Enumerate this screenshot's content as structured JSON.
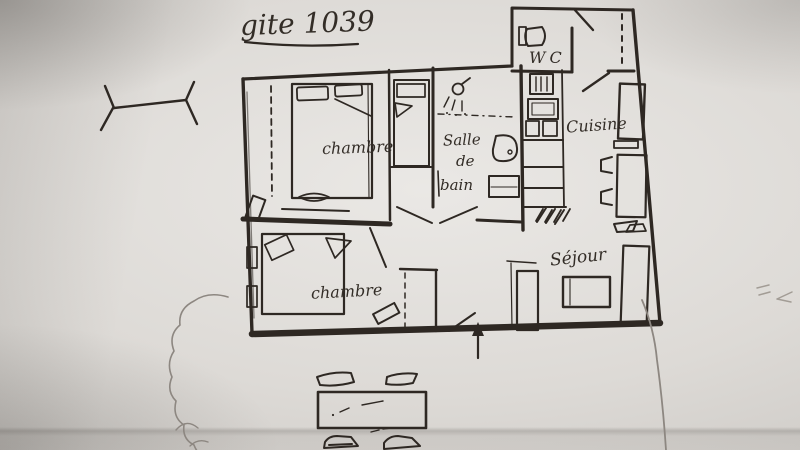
{
  "title": "gite 1039",
  "rooms": {
    "wc": "WC",
    "cuisine": "Cuisine",
    "salle_de_bain": [
      "Salle",
      "de",
      "bain"
    ],
    "chambre_top": "chambre",
    "chambre_bottom": "chambre",
    "sejour": "Séjour"
  },
  "colors": {
    "ink": "#2e2823",
    "pencil": "#8d8781",
    "paper_light": "#eae8e5",
    "paper_dark": "#c4c1bd"
  },
  "furniture_icons": [
    "toilet-icon",
    "shower-icon",
    "sink-icon",
    "washer-icon",
    "double-bed-icon",
    "single-bed-icon",
    "bed-icon",
    "wardrobe-dashed-icon",
    "stove-icon",
    "kitchen-counter-icon",
    "fridge-icon",
    "kitchen-table-icon",
    "chair-icon",
    "sofa-icon",
    "coffee-table-icon",
    "tv-stand-icon",
    "patio-table-icon",
    "patio-chair-icon",
    "bush-icon",
    "entrance-arrow-icon",
    "branch-mark-icon",
    "door-swing-icon"
  ]
}
